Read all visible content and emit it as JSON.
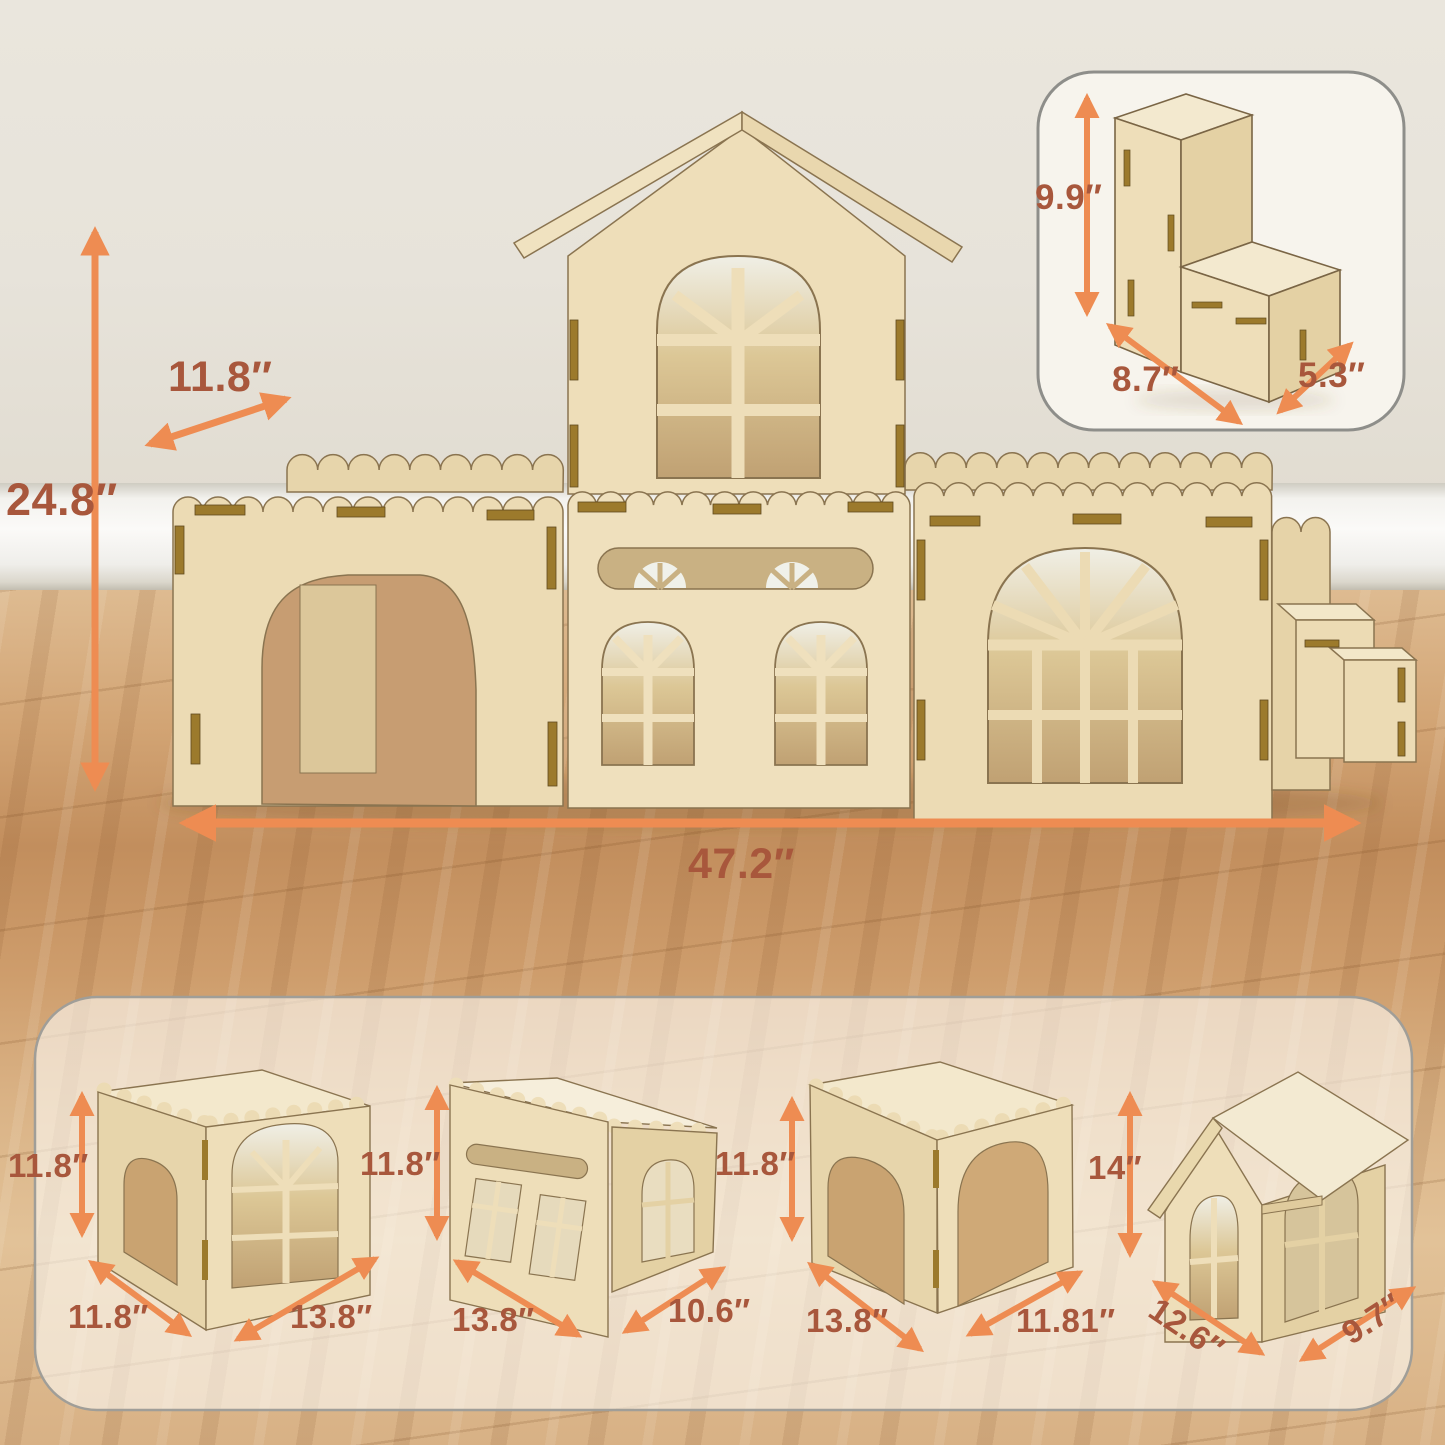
{
  "dims": {
    "main": {
      "height": "24.8″",
      "depth": "11.8″",
      "width": "47.2″"
    },
    "inset": {
      "height": "9.9″",
      "width": "8.7″",
      "depth": "5.3″"
    },
    "module1": {
      "height": "11.8″",
      "depth": "11.8″",
      "width": "13.8″"
    },
    "module2": {
      "height": "11.8″",
      "width": "13.8″",
      "depth": "10.6″"
    },
    "module3": {
      "height": "11.8″",
      "width": "13.8″",
      "depth": "11.81″"
    },
    "module4": {
      "height": "14″",
      "width": "12.6″",
      "depth": "9.7″"
    }
  },
  "colors": {
    "arrow": "#ee8c52",
    "label": "#a8573c",
    "plywood": "#ecdbb4",
    "wall": "#e9e5dc",
    "floor": "#d2a878"
  }
}
